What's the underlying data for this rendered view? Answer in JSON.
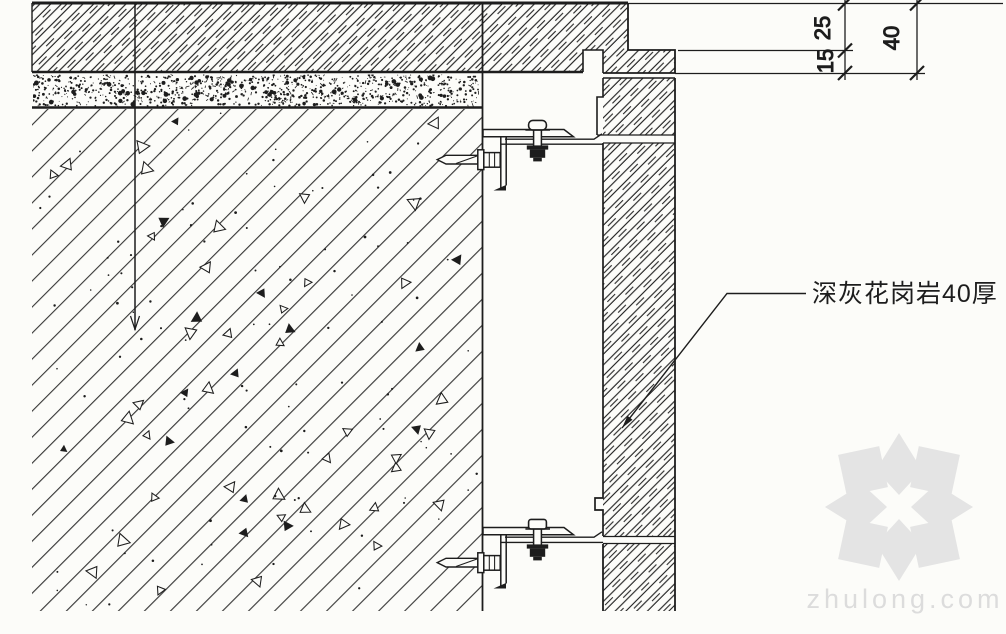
{
  "colors": {
    "paper": "#fcfcf9",
    "ink": "#1d1d1d",
    "watermark_logo": "#e4e4e4",
    "watermark_text": "#dcdcdc"
  },
  "dimensions": {
    "upper_offset": "25",
    "lower_offset": "15",
    "panel_thickness": "40"
  },
  "annotation": {
    "granite_label": "深灰花岗岩40厚"
  },
  "watermark": {
    "text": "zhulong.com",
    "logo": "zhulong-pinwheel-logo"
  }
}
